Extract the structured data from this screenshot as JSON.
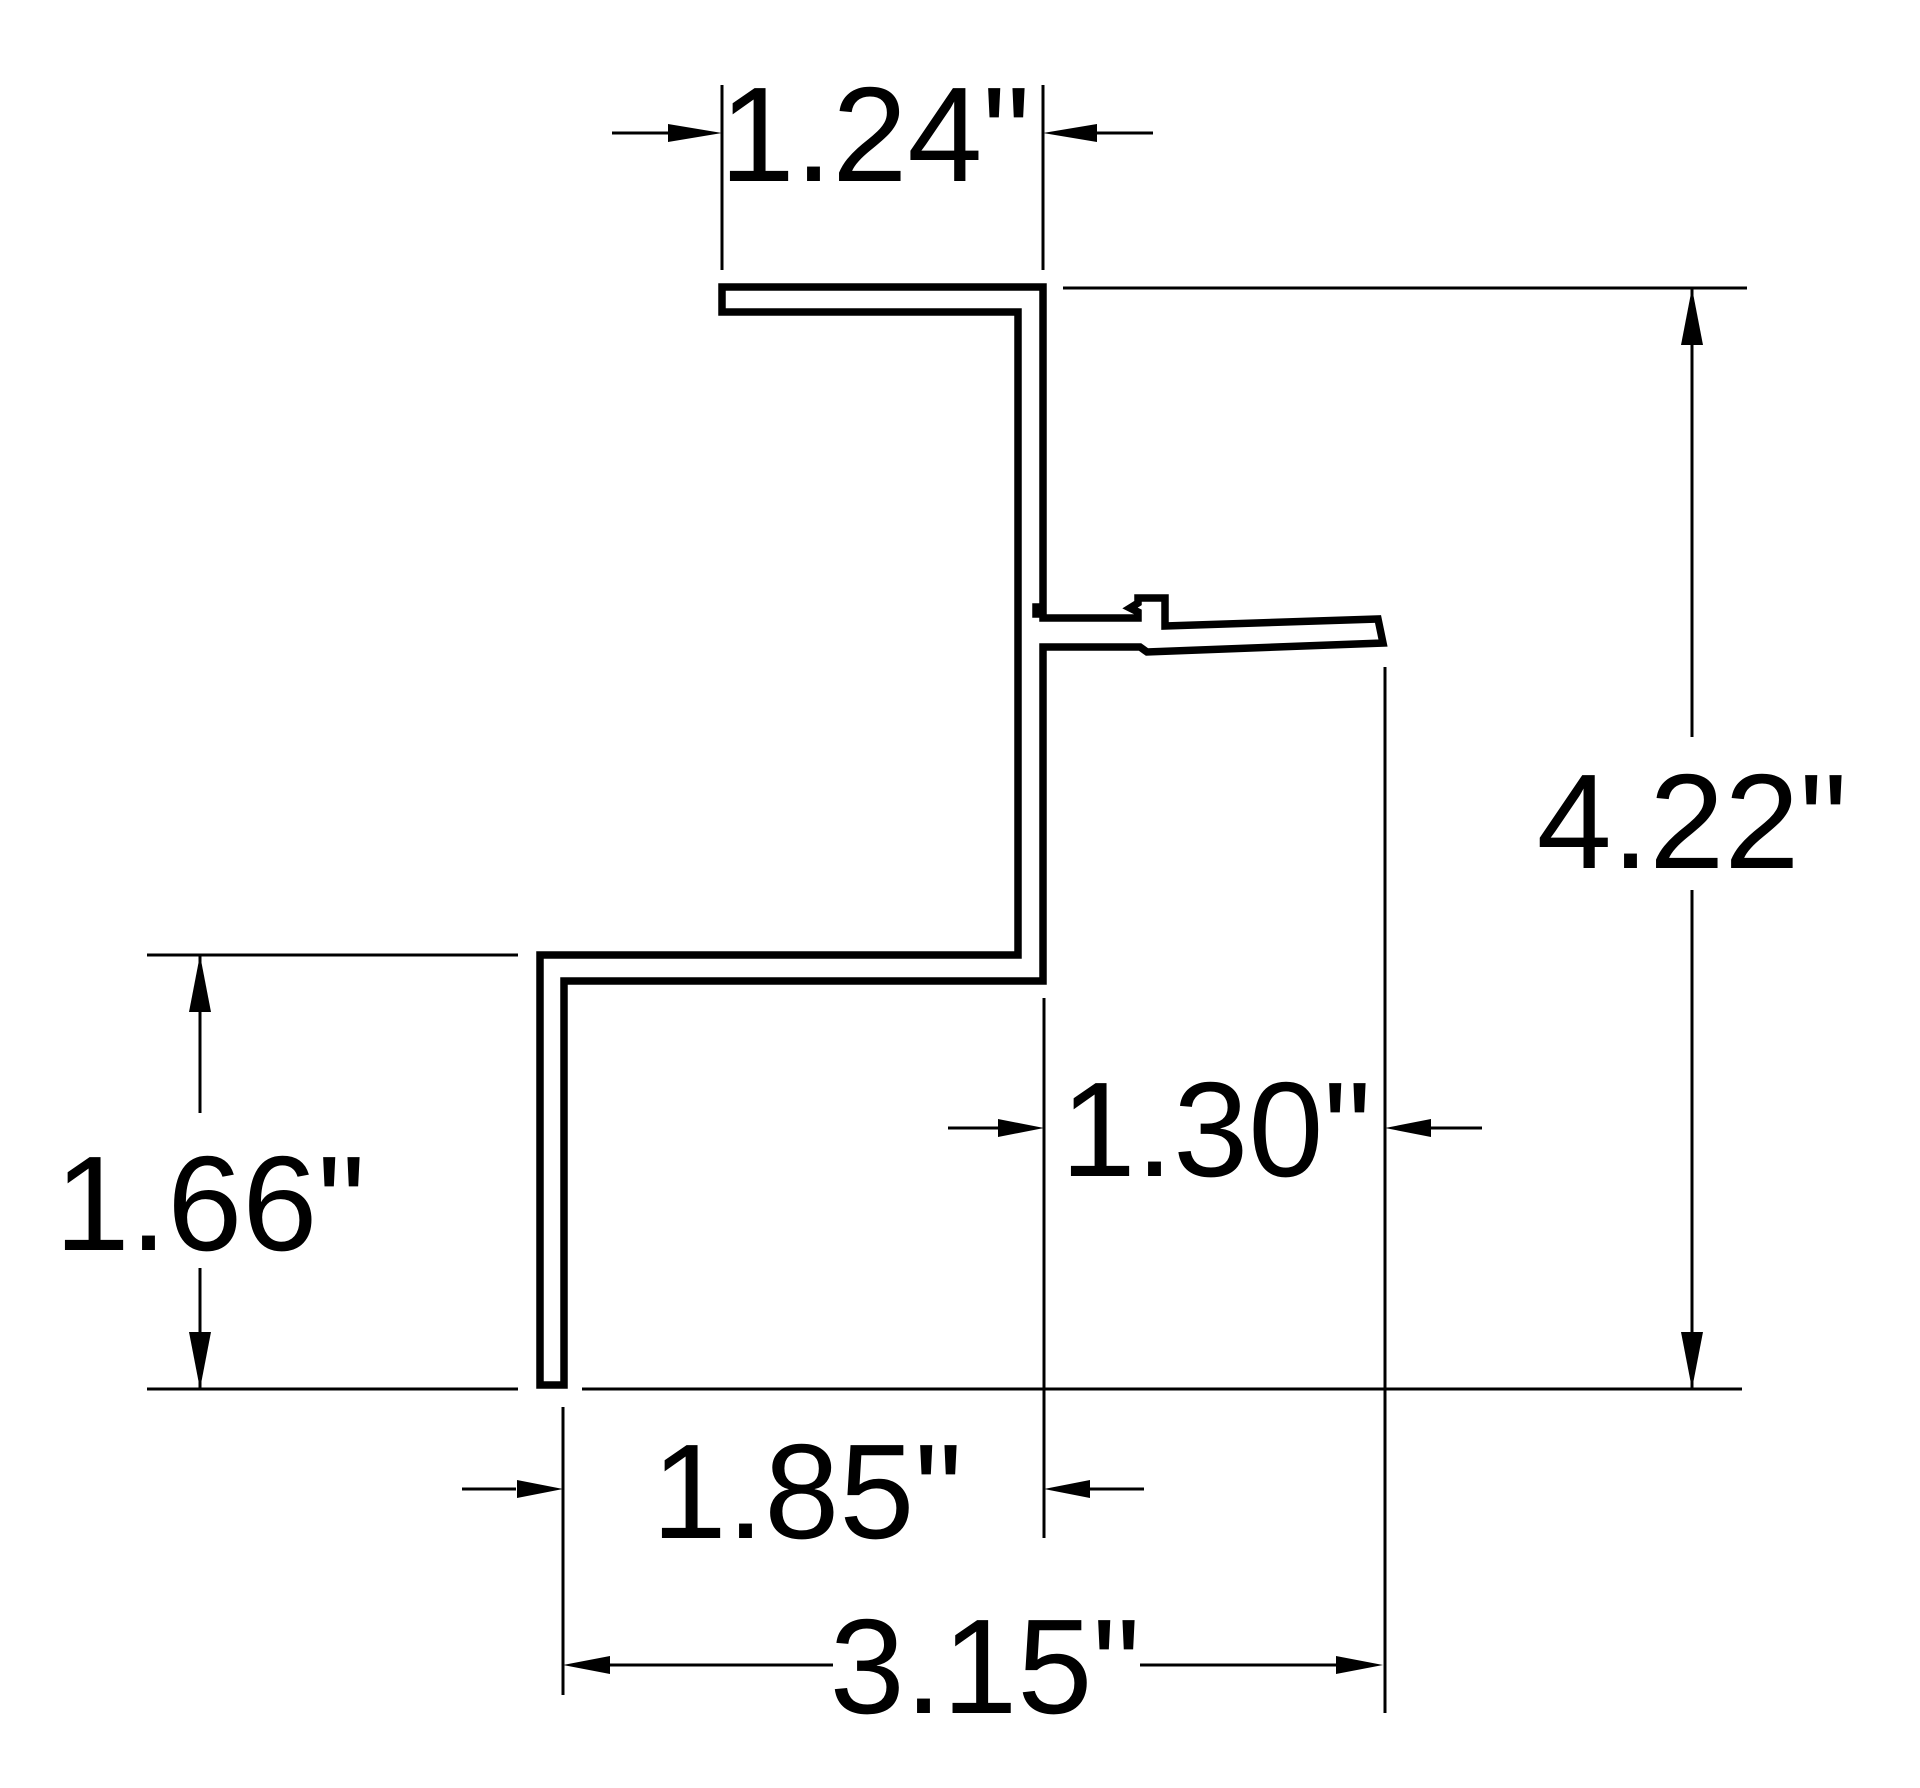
{
  "drawing": {
    "title": "extrusion-profile-cross-section",
    "units": "inches",
    "colors": {
      "background": "#ffffff",
      "line": "#000000",
      "text": "#000000"
    },
    "labels": {
      "top_width": "1.24\"",
      "overall_height": "4.22\"",
      "left_leg_height": "1.66\"",
      "pocket_width": "1.30\"",
      "lower_width": "1.85\"",
      "overall_width": "3.15\""
    }
  }
}
